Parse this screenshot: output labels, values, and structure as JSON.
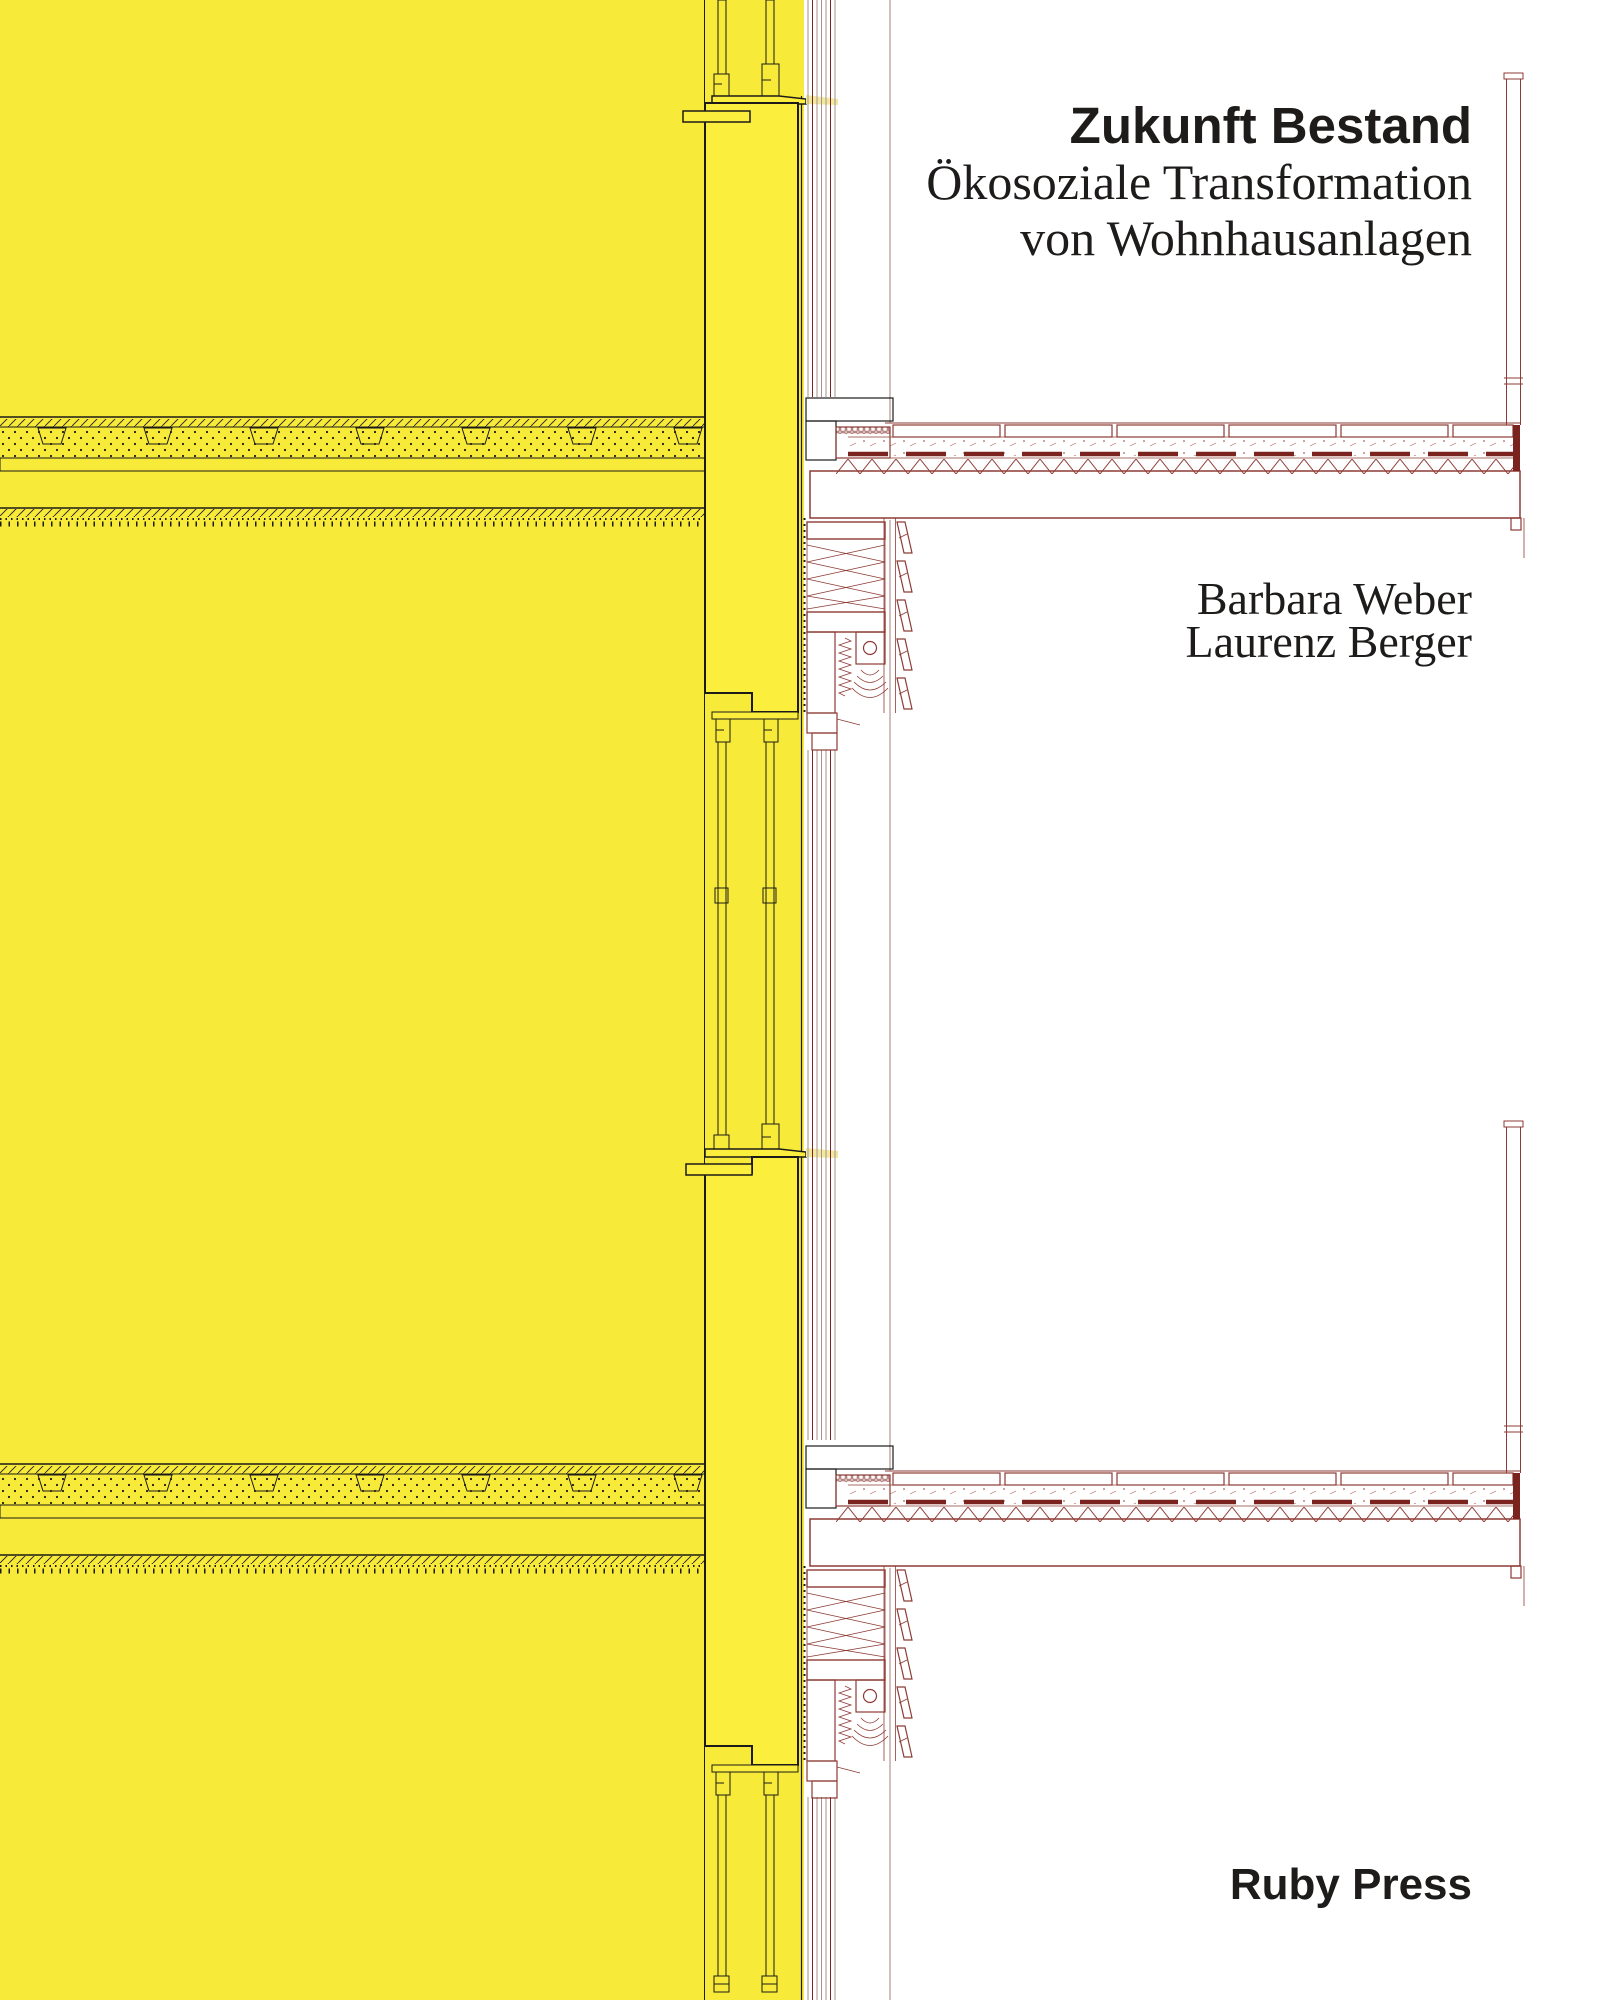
{
  "cover": {
    "title": "Zukunft Bestand",
    "subtitle": [
      "Ökosoziale Transformation",
      "von Wohnhausanlagen"
    ],
    "authors": [
      "Barbara Weber",
      "Laurenz Berger"
    ],
    "publisher": "Ruby Press"
  },
  "colors": {
    "background": "#FFFFFF",
    "yellow_field": "#F7EA39",
    "pier_fill": "#FCEE3D",
    "ink_black": "#1D1B19",
    "maroon": "#8D3B34",
    "maroon_dark": "#7B241F",
    "maroon_hatch": "#A8625B",
    "stripe_gray": "#A4938D",
    "pale_sill": "#F2E8A0",
    "text": "#1E1C1A"
  }
}
